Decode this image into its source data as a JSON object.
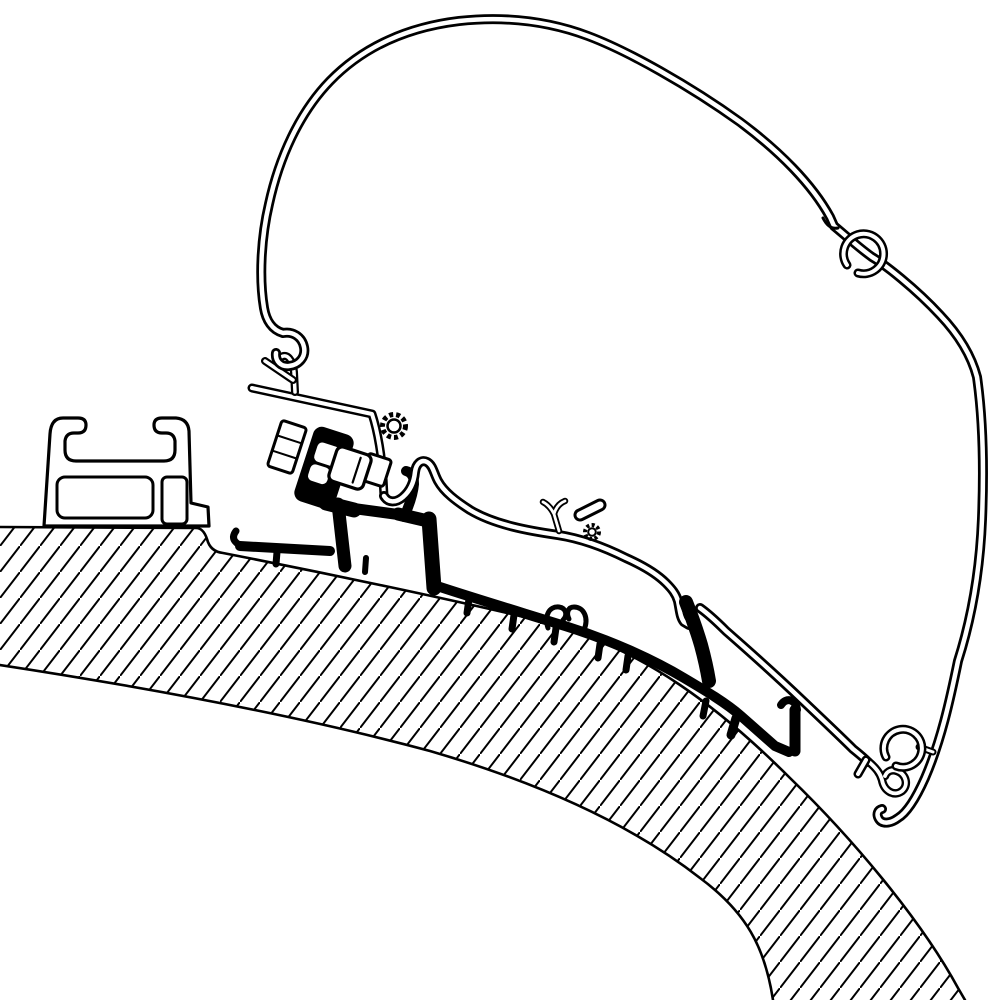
{
  "figure": {
    "type": "technical-line-drawing",
    "subject": "Awning roof adapter cross-section profile diagram",
    "background_color": "#ffffff",
    "line_color": "#000000",
    "text_items": []
  },
  "hatch": {
    "style": "diagonal-section-hatching",
    "direction": "bottom-left-to-top-right",
    "angle_deg": 52,
    "spacing_px": 16,
    "stroke_px": 2
  },
  "parts": [
    {
      "id": 0,
      "label": "curved vehicle roof panel (hatched section)"
    },
    {
      "id": 1,
      "label": "left mounting rail profile with T-slot channel"
    },
    {
      "id": 2,
      "label": "large curved awning cassette profile (thin wall outline)"
    },
    {
      "id": 3,
      "label": "black adapter rail profile with support feet"
    },
    {
      "id": 4,
      "label": "mounting bracket arm with serrated adjustment boss"
    },
    {
      "id": 5,
      "label": "hex bolt head"
    },
    {
      "id": 6,
      "label": "square clamp nut"
    },
    {
      "id": 7,
      "label": "bolt shaft"
    },
    {
      "id": 8,
      "label": "black clamp block with windows"
    },
    {
      "id": 9,
      "label": "intermediate rail strip with antler clip and boss"
    },
    {
      "id": 10,
      "label": "hook joint engaging adapter leg"
    },
    {
      "id": 11,
      "label": "upper C-hook detail on cassette profile"
    },
    {
      "id": 12,
      "label": "lower C-hook and end hooks of cassette profile"
    }
  ]
}
